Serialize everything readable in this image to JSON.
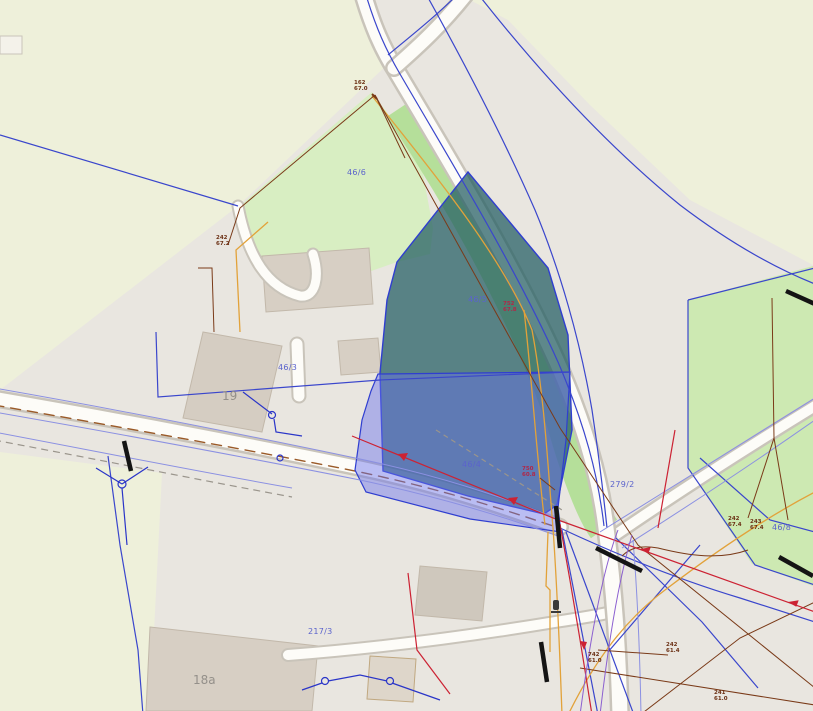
{
  "app": {
    "type": "cadastral-gis-map-view"
  },
  "labels": {
    "parcels": [
      "46/6",
      "46/5",
      "46/3",
      "46/4",
      "279/2",
      "46/8",
      "217/3"
    ],
    "buildings": [
      "19",
      "18a"
    ],
    "utilities": [
      {
        "l1": "162",
        "l2": "67.0"
      },
      {
        "l1": "242",
        "l2": "67.2"
      },
      {
        "l1": "752",
        "l2": "67.8"
      },
      {
        "l1": "750",
        "l2": "60.8"
      },
      {
        "l1": "242",
        "l2": "67.4"
      },
      {
        "l1": "243",
        "l2": "67.4"
      },
      {
        "l1": "742",
        "l2": "61.0"
      },
      {
        "l1": "242",
        "l2": "61.4"
      },
      {
        "l1": "241",
        "l2": "61.0"
      }
    ]
  },
  "colors": {
    "base_gray": "#e9e6e0",
    "field_green": "#eef0da",
    "meadow_green": "#d8eec2",
    "verge_green": "#b5df9a",
    "parcel_right_green": "#cde9b2",
    "building_fill": "#d7cfc4",
    "road_fill": "#fdfcf8",
    "road_casing": "#c9c4ba",
    "boundary_blue": "#3a46cc",
    "parallel_periwinkle": "#8b90e2",
    "selected_teal": "rgba(32,92,97,0.72)",
    "selected_violet": "rgba(105,112,238,0.45)",
    "utility_orange": "#e2a23a",
    "utility_brown": "#7a3a18",
    "utility_red": "#cc2233",
    "utility_blue": "#2a35c8",
    "utility_violet": "#8b5fd0",
    "black_line": "#141414",
    "label_blue": "#5b63cc",
    "label_gray": "#94908a",
    "label_brown": "#6b3014",
    "label_red": "#b02848"
  }
}
